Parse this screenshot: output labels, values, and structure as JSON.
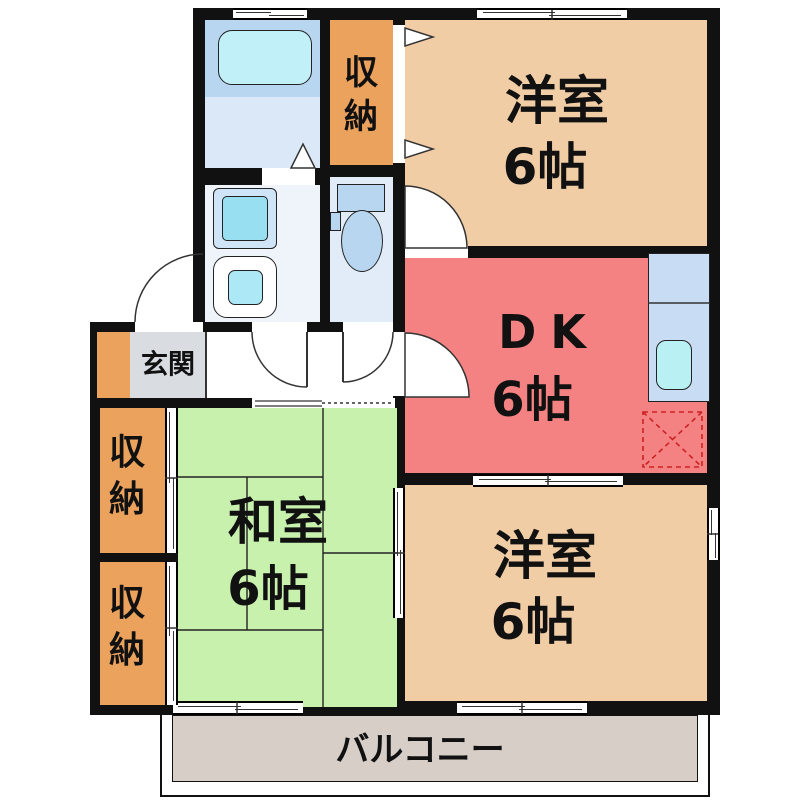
{
  "floorplan": {
    "type": "apartment-floor-plan",
    "rooms": {
      "yoshitsu_top": {
        "name": "洋室",
        "size": "6帖"
      },
      "dk": {
        "name": "DK",
        "size": "6帖"
      },
      "yoshitsu_bottom": {
        "name": "洋室",
        "size": "6帖"
      },
      "washitsu": {
        "name": "和室",
        "size": "6帖"
      },
      "shuno_top": {
        "name": "収納"
      },
      "shuno_mid": {
        "name": "収納"
      },
      "shuno_low": {
        "name": "収納"
      },
      "genkan": {
        "name": "玄関"
      },
      "balcony": {
        "name": "バルコニー"
      }
    },
    "fixtures": [
      "bathtub-icon",
      "washbasin-icon",
      "washing-machine-icon",
      "toilet-icon",
      "kitchen-counter-icon",
      "kitchen-sink-icon",
      "refrigerator-space-icon"
    ],
    "colors": {
      "wall": "#111111",
      "room_western": "#f1cda6",
      "room_dk": "#f58282",
      "room_tatami": "#c9f1ae",
      "storage": "#eba25d",
      "genkan_floor": "#d9dde2",
      "balcony_floor": "#d7cec7",
      "bath_floor": "#dbe8f8",
      "washroom_floor": "#eff4fb",
      "toilet_floor": "#e2ebf8",
      "fixture_panel": "#b9d6f0",
      "tub_water": "#c2f0f8",
      "sink_water": "#b8f0f4",
      "basin_water": "#99dff2",
      "washer_water": "#ace8f5",
      "kitchen_counter": "#c8ddf3",
      "fridge_dash": "#cc2222"
    }
  }
}
